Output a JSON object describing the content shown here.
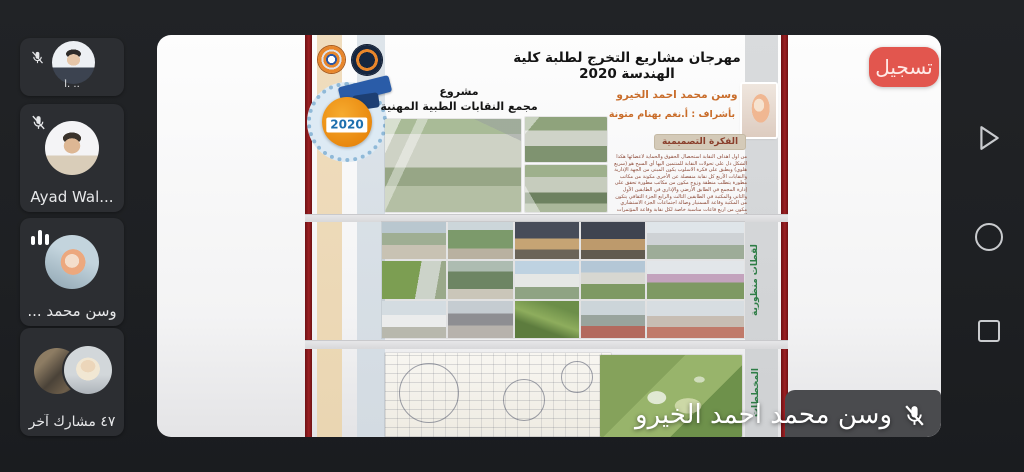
{
  "app": {
    "recording_badge": "تسجيل",
    "speaker_overlay": {
      "name": "وسن محمد احمد الخيرو",
      "mic": "muted"
    }
  },
  "sidebar": {
    "participants": [
      {
        "label": "أ. ..",
        "mic": "muted"
      },
      {
        "label": "Ayad Wal...",
        "mic": "muted"
      },
      {
        "label": "وسن محمد ...",
        "mic": "speaking"
      },
      {
        "label": "٤٧ مشارك آخر",
        "mic": "none"
      }
    ]
  },
  "nav": {
    "back_icon": "back-triangle",
    "home_icon": "home-circle",
    "recents_icon": "recents-square"
  },
  "slide": {
    "title": "مهرجان مشاريع التخرج لطلبة كلية الهندسة 2020",
    "project_line1": "مشروع",
    "project_line2": "مجمع النقابات الطبية المهنية",
    "student_name": "وسن محمد احمد الخيرو",
    "supervisor": "بأشراف : أ.نغم بهنام متونة",
    "badge_year": "2020",
    "concept_heading": "الفكرة التصميمية",
    "concept_body": "من اول اهداف النقابة استحصال الحقوق والحماية لأعضائها هكذا الشكل دل على تحولات النقابة للمنتمين اليها أي السبح هو (سريع هلوي) ويطبق على فكرة الاسلوب يكون المبنى من الجهة الإدارية والنقابات الأربع كل نقابة منفصلة عن الأخرى مكونة من مكاتب مطورة يتطلب منطقة وزوج مكون من مكاتب مطورة تحقق على إدارة المجمع في الطابق الأرضي والإداري في الطابقين الأول والثاني والمكتبة في الطابقين الثالث والرابع الجزء الثقافي يتكون من المكتبة وقاعة السمنيار وصالة اجتماعات الجزء الاستشاري مكون من اربع قاعات مناسبة خاصة لكل نقابة وقاعة المؤتمرات المركزية وتتضم",
    "vertical_label_top": "لقطات منظورية",
    "vertical_label_bottom": "المخططات"
  }
}
